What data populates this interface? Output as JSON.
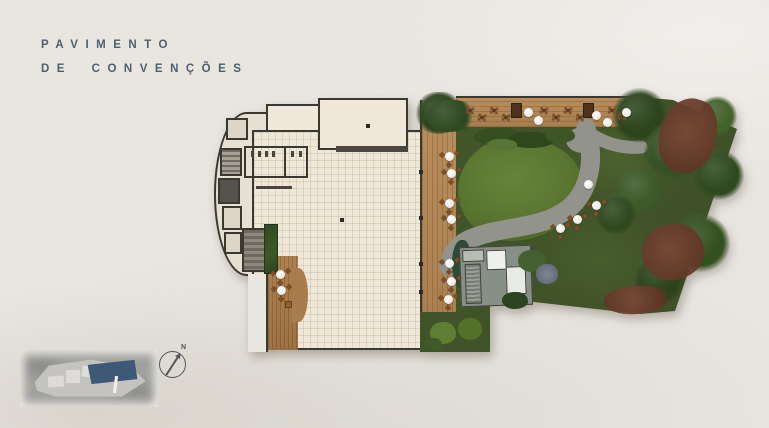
{
  "title": {
    "line1": "PAVIMENTO",
    "line2": "DE CONVENÇÕES"
  },
  "compass": {
    "label": "N"
  },
  "colors": {
    "paper": "#eae7e1",
    "title": "#4d5f6e",
    "wall": "#3b3832",
    "cream": "#efe8d8",
    "wood": "#b28757",
    "lawn": "#5d7833",
    "garden": "#46592c",
    "hedge": "#35501f",
    "path": "#92948b",
    "mulch": "#6c4030",
    "structure": "#8d948c",
    "chair": "#7b4f2a",
    "map-highlight": "#3d5977",
    "compass": "#55565a"
  }
}
